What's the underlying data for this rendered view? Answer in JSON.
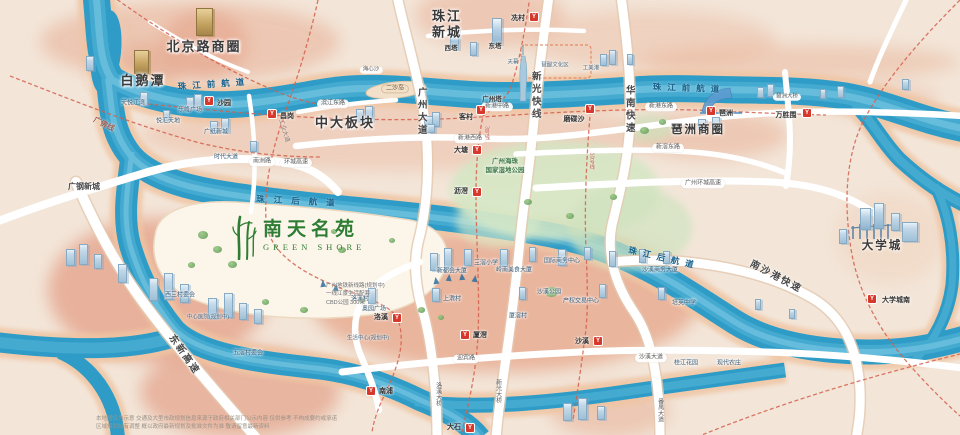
{
  "project": {
    "name": "南天名苑",
    "name_en": "GREEN SHORE",
    "notes": [
      "广州地铁新线路(规划中)",
      "一线江景生活配套",
      "CBD公园 300米"
    ]
  },
  "station_glyph": "Y",
  "colors": {
    "water": "#2e9cc6",
    "land": "#f3e6d9",
    "built_area": "#e7ad93",
    "road": "#ffffff",
    "metro_dash": "#d4604e",
    "station": "#d6392c",
    "park": "#cfe4c0",
    "project_green": "#2e7d32"
  },
  "labels": [
    {
      "name": "district-beijing-road",
      "text": "北京路商圈",
      "x": 204,
      "y": 47,
      "cls": "dist"
    },
    {
      "name": "district-baietan",
      "text": "白鹅潭",
      "x": 143,
      "y": 81,
      "cls": "dist"
    },
    {
      "name": "district-zhujiang-new-town",
      "text": "珠江\n新城",
      "x": 447,
      "y": 24,
      "cls": "dist"
    },
    {
      "name": "district-zhongda",
      "text": "中大板块",
      "x": 345,
      "y": 123,
      "cls": "dist"
    },
    {
      "name": "district-pazhou",
      "text": "琶洲商圈",
      "x": 698,
      "y": 131,
      "cls": "dist2"
    },
    {
      "name": "district-university-town",
      "text": "大学城",
      "x": 882,
      "y": 247,
      "cls": "dist2"
    },
    {
      "name": "district-guanggang",
      "text": "广钢新城",
      "x": 84,
      "y": 187,
      "cls": "dist3"
    },
    {
      "name": "river-front-west",
      "text": "珠江前航道",
      "x": 214,
      "y": 84,
      "cls": "river",
      "rot": -4
    },
    {
      "name": "river-front-east",
      "text": "珠江前航道",
      "x": 689,
      "y": 88,
      "cls": "river",
      "rot": 2
    },
    {
      "name": "river-back-west",
      "text": "珠江后航道",
      "x": 300,
      "y": 201,
      "cls": "river river2",
      "rot": 3
    },
    {
      "name": "river-back-east",
      "text": "珠江后航道",
      "x": 664,
      "y": 258,
      "cls": "river",
      "rot": 13
    },
    {
      "name": "hwy-guangzhou-avenue",
      "text": "广州大道",
      "x": 421,
      "y": 112,
      "cls": "vroad"
    },
    {
      "name": "hwy-xinguang-express",
      "text": "新光快线",
      "x": 535,
      "y": 96,
      "cls": "vroad"
    },
    {
      "name": "hwy-huanan-express",
      "text": "华南快速",
      "x": 629,
      "y": 110,
      "cls": "vroad"
    },
    {
      "name": "hwy-nansha-port-express",
      "text": "南沙港快速",
      "x": 776,
      "y": 277,
      "cls": "hrot",
      "rot": 28
    },
    {
      "name": "hwy-dongxin-express",
      "text": "东新高速",
      "x": 184,
      "y": 355,
      "cls": "hrot",
      "rot": 55
    },
    {
      "name": "metro-guangfo-line",
      "text": "广佛线",
      "x": 104,
      "y": 124,
      "cls": "hrotsm",
      "rot": 27
    },
    {
      "name": "road-industry-avenue",
      "text": "工业大道",
      "x": 283,
      "y": 131,
      "cls": "tinyrot",
      "rot": 73
    },
    {
      "name": "metro-line3-label",
      "text": "3号线",
      "x": 486,
      "y": 133,
      "cls": "mlabel"
    },
    {
      "name": "metro-line10-label",
      "text": "10号线",
      "x": 591,
      "y": 161,
      "cls": "mlabel"
    },
    {
      "name": "bridge-panyu-avenue",
      "text": "番禺大道",
      "x": 659,
      "y": 410,
      "cls": "vbridge"
    },
    {
      "name": "bridge-luoxi",
      "text": "洛溪大桥",
      "x": 437,
      "y": 394,
      "cls": "vbridge"
    },
    {
      "name": "bridge-xinguang",
      "text": "新光大桥",
      "x": 497,
      "y": 391,
      "cls": "vbridge"
    },
    {
      "name": "road-binjiang-east",
      "text": "滨江东路",
      "x": 333,
      "y": 104,
      "cls": "pill"
    },
    {
      "name": "road-xingang-west",
      "text": "新港西路",
      "x": 470,
      "y": 139,
      "cls": "pill"
    },
    {
      "name": "road-xingang-middle",
      "text": "新港中路",
      "x": 497,
      "y": 107,
      "cls": "pill"
    },
    {
      "name": "road-xingang-east",
      "text": "新港东路",
      "x": 661,
      "y": 107,
      "cls": "pill"
    },
    {
      "name": "road-xinjiao-east",
      "text": "新滘东路",
      "x": 668,
      "y": 148,
      "cls": "pill"
    },
    {
      "name": "road-ring-expressway",
      "text": "广州环城高速",
      "x": 703,
      "y": 184,
      "cls": "pill"
    },
    {
      "name": "road-ring-expressway-west",
      "text": "环城高速",
      "x": 296,
      "y": 163,
      "cls": "pill"
    },
    {
      "name": "road-nanzhou",
      "text": "南洲路",
      "x": 262,
      "y": 162,
      "cls": "pill"
    },
    {
      "name": "road-yingbin",
      "text": "迎宾路",
      "x": 466,
      "y": 359,
      "cls": "pill"
    },
    {
      "name": "road-shaxi-avenue",
      "text": "沙溪大道",
      "x": 651,
      "y": 358,
      "cls": "pill"
    },
    {
      "name": "bridge-pazhou",
      "text": "琶洲大桥",
      "x": 787,
      "y": 97,
      "cls": "pillxs"
    },
    {
      "name": "island-ersha",
      "text": "二沙岛",
      "x": 395,
      "y": 89,
      "cls": "pillbg"
    },
    {
      "name": "island-haixinsha",
      "text": "海心沙",
      "x": 371,
      "y": 70,
      "cls": "pillxs"
    },
    {
      "name": "poi-tianyue-jiangwan",
      "text": "天悦江湾",
      "x": 133,
      "y": 104,
      "cls": "tiny"
    },
    {
      "name": "poi-lefeng-plaza",
      "text": "乐峰广场",
      "x": 190,
      "y": 111,
      "cls": "tiny"
    },
    {
      "name": "poi-yuehui-tiandi",
      "text": "悦汇天地",
      "x": 168,
      "y": 122,
      "cls": "tiny"
    },
    {
      "name": "poi-guangzhi-new-town",
      "text": "广纸新城",
      "x": 216,
      "y": 133,
      "cls": "tiny"
    },
    {
      "name": "poi-shidai-avenue",
      "text": "时代大道",
      "x": 226,
      "y": 158,
      "cls": "tiny"
    },
    {
      "name": "poi-west-tower",
      "text": "西塔",
      "x": 451,
      "y": 49,
      "cls": "tiny2"
    },
    {
      "name": "poi-east-tower",
      "text": "东塔",
      "x": 495,
      "y": 47,
      "cls": "tiny2"
    },
    {
      "name": "poi-canton-tower",
      "text": "广州塔",
      "x": 492,
      "y": 100,
      "cls": "tiny2"
    },
    {
      "name": "poi-tianmu",
      "text": "天幕",
      "x": 513,
      "y": 63,
      "cls": "tinyxs"
    },
    {
      "name": "poi-bati",
      "text": "琶醍文化区",
      "x": 555,
      "y": 66,
      "cls": "tinyxs"
    },
    {
      "name": "poi-gongmeigang",
      "text": "工美港",
      "x": 591,
      "y": 69,
      "cls": "tinyxs"
    },
    {
      "name": "poi-wetland-park",
      "text": "广州海珠\n国家湿地公园",
      "x": 505,
      "y": 167,
      "cls": "tinygreen"
    },
    {
      "name": "poi-luoxi-village",
      "text": "洛溪村",
      "x": 360,
      "y": 300,
      "cls": "tiny"
    },
    {
      "name": "poi-aoyuan-plaza",
      "text": "奥园广场",
      "x": 374,
      "y": 310,
      "cls": "tiny"
    },
    {
      "name": "poi-shangjiao-village",
      "text": "上漖村",
      "x": 452,
      "y": 300,
      "cls": "tiny"
    },
    {
      "name": "poi-xinduhui",
      "text": "新都会大厦",
      "x": 452,
      "y": 272,
      "cls": "tiny"
    },
    {
      "name": "poi-sanjiao-school",
      "text": "三滘小学",
      "x": 486,
      "y": 264,
      "cls": "tiny"
    },
    {
      "name": "poi-lingnan-food",
      "text": "岭南美食大厦",
      "x": 514,
      "y": 271,
      "cls": "tiny"
    },
    {
      "name": "poi-intl-business-center",
      "text": "国际商务中心",
      "x": 562,
      "y": 262,
      "cls": "tiny"
    },
    {
      "name": "poi-shaxi-business",
      "text": "沙溪商务大厦",
      "x": 660,
      "y": 271,
      "cls": "tiny"
    },
    {
      "name": "poi-shaxi-park",
      "text": "沙溪公园",
      "x": 549,
      "y": 293,
      "cls": "tiny"
    },
    {
      "name": "poi-property-exchange",
      "text": "产权交易中心",
      "x": 581,
      "y": 302,
      "cls": "tiny"
    },
    {
      "name": "poi-peiying-school",
      "text": "培英中学",
      "x": 684,
      "y": 304,
      "cls": "tiny"
    },
    {
      "name": "poi-xiajiao-village",
      "text": "厦滘村",
      "x": 518,
      "y": 317,
      "cls": "tiny"
    },
    {
      "name": "poi-xisan-village",
      "text": "西三村委会",
      "x": 180,
      "y": 296,
      "cls": "tiny"
    },
    {
      "name": "poi-central-hospital",
      "text": "中心医院(规划中)",
      "x": 208,
      "y": 318,
      "cls": "tinyxs"
    },
    {
      "name": "poi-wujiao-village",
      "text": "五滘村委会",
      "x": 248,
      "y": 354,
      "cls": "tiny"
    },
    {
      "name": "poi-guijiang-garden",
      "text": "桂江花园",
      "x": 686,
      "y": 364,
      "cls": "tiny"
    },
    {
      "name": "poi-modern-farm",
      "text": "现代农庄",
      "x": 729,
      "y": 364,
      "cls": "tiny"
    },
    {
      "name": "poi-life-center",
      "text": "生活中心(规划中)",
      "x": 368,
      "y": 339,
      "cls": "tinyxs"
    }
  ],
  "stations": [
    {
      "name": "station-shayuan",
      "text": "沙园",
      "icon": [
        209,
        101
      ],
      "label": [
        224,
        104
      ]
    },
    {
      "name": "station-changgang",
      "text": "昌岗",
      "icon": [
        272,
        114
      ],
      "label": [
        287,
        117
      ]
    },
    {
      "name": "station-kecun",
      "text": "客村",
      "icon": [
        481,
        110
      ],
      "label": [
        466,
        118
      ]
    },
    {
      "name": "station-xiancun",
      "text": "冼村",
      "icon": [
        534,
        17
      ],
      "label": [
        518,
        19
      ]
    },
    {
      "name": "station-modiesha",
      "text": "磨碟沙",
      "icon": [
        590,
        109
      ],
      "label": [
        574,
        120
      ]
    },
    {
      "name": "station-pazhou",
      "text": "琶洲",
      "icon": [
        711,
        111
      ],
      "label": [
        726,
        114
      ]
    },
    {
      "name": "station-wanshengwei",
      "text": "万胜围",
      "icon": [
        807,
        113
      ],
      "label": [
        786,
        116
      ]
    },
    {
      "name": "station-datang",
      "text": "大塘",
      "icon": [
        477,
        150
      ],
      "label": [
        461,
        151
      ]
    },
    {
      "name": "station-lijiao",
      "text": "沥滘",
      "icon": [
        477,
        192
      ],
      "label": [
        461,
        192
      ]
    },
    {
      "name": "station-luoxi",
      "text": "洛溪",
      "icon": [
        397,
        318
      ],
      "label": [
        381,
        318
      ]
    },
    {
      "name": "station-xiajiao",
      "text": "厦滘",
      "icon": [
        465,
        335
      ],
      "label": [
        480,
        336
      ]
    },
    {
      "name": "station-shaxi",
      "text": "沙溪",
      "icon": [
        598,
        341
      ],
      "label": [
        582,
        342
      ]
    },
    {
      "name": "station-nanpu",
      "text": "南浦",
      "icon": [
        371,
        391
      ],
      "label": [
        386,
        392
      ]
    },
    {
      "name": "station-dashi",
      "text": "大石",
      "icon": [
        470,
        428
      ],
      "label": [
        454,
        428
      ]
    },
    {
      "name": "station-university-town-south",
      "text": "大学城南",
      "icon": [
        872,
        299
      ],
      "label": [
        896,
        301
      ]
    }
  ],
  "disclaimer": [
    "本地图仅为示意 交通及大型市政规划信息来源于政府相关部门公示内容 仅供参考 不构成要约或承诺",
    "区域规划如有调整 概以政府最新规划及批准文件为准 敬请留意最新资料"
  ]
}
